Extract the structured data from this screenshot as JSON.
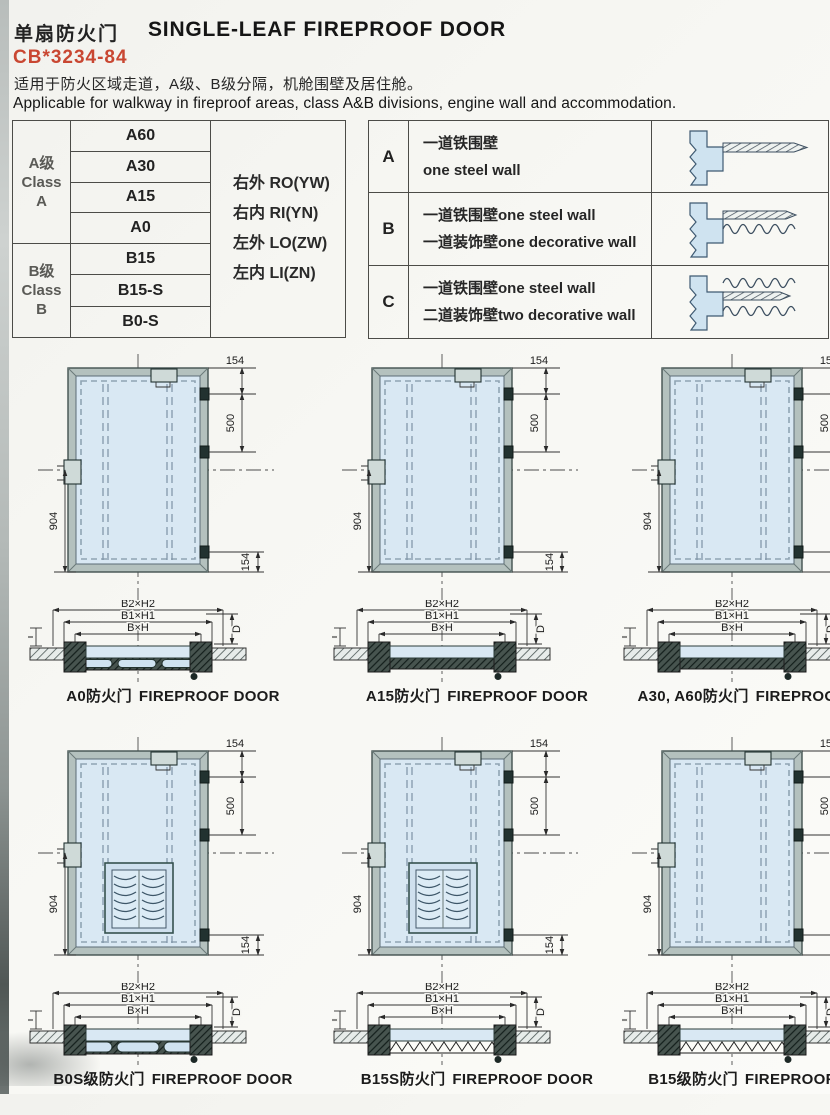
{
  "header": {
    "title_cn": "单扇防火门",
    "title_en": "SINGLE-LEAF FIREPROOF DOOR",
    "standard_no": "CB*3234-84",
    "desc_cn": "适用于防火区域走道，A级、B级分隔，机舱围壁及居住舱。",
    "desc_en": "Applicable for walkway in fireproof areas, class A&B divisions, engine wall and accommodation."
  },
  "class_table": {
    "class_a": {
      "label_cn": "A级",
      "label_en_line1": "Class",
      "label_en_line2": "A",
      "ratings": [
        "A60",
        "A30",
        "A15",
        "A0"
      ]
    },
    "class_b": {
      "label_cn": "B级",
      "label_en_line1": "Class",
      "label_en_line2": "B",
      "ratings": [
        "B15",
        "B15-S",
        "B0-S"
      ]
    },
    "orientations": [
      "右外 RO(YW)",
      "右内 RI(YN)",
      "左外 LO(ZW)",
      "左内 LI(ZN)"
    ]
  },
  "wall_table": {
    "rows": [
      {
        "key": "A",
        "line1": "一道铁围壁",
        "line2": "one steel wall"
      },
      {
        "key": "B",
        "line1": "一道铁围壁one steel wall",
        "line2": "一道装饰壁one decorative wall"
      },
      {
        "key": "C",
        "line1": "一道铁围壁one steel wall",
        "line2": "二道装饰壁two decorative wall"
      }
    ]
  },
  "door_dims": {
    "top_inset": "154",
    "hinge_spacing": "500",
    "handle_height": "904",
    "bottom_inset": "154"
  },
  "section_labels": {
    "outer": "B2×H2",
    "frame": "B1×H1",
    "clear": "B×H",
    "depth": "D",
    "thickness": "T"
  },
  "figures": [
    {
      "caption_cn": "A0防火门",
      "caption_en": "FIREPROOF DOOR",
      "louver": false,
      "section": "hatchpanels"
    },
    {
      "caption_cn": "A15防火门",
      "caption_en": "FIREPROOF DOOR",
      "louver": false,
      "section": "hatch"
    },
    {
      "caption_cn": "A30, A60防火门",
      "caption_en": "FIREPROOF DOOR",
      "louver": false,
      "section": "hatch"
    },
    {
      "caption_cn": "B0S级防火门",
      "caption_en": "FIREPROOF DOOR",
      "louver": true,
      "section": "panels"
    },
    {
      "caption_cn": "B15S防火门",
      "caption_en": "FIREPROOF DOOR",
      "louver": true,
      "section": "zigzag"
    },
    {
      "caption_cn": "B15级防火门",
      "caption_en": "FIREPROOF DOOR",
      "louver": false,
      "section": "zigzag"
    }
  ],
  "colors": {
    "standard_red": "#c94732",
    "leaf_blue": "#d9e8f3",
    "frame_gray": "#b4c1be",
    "ink": "#1c1c1c"
  }
}
